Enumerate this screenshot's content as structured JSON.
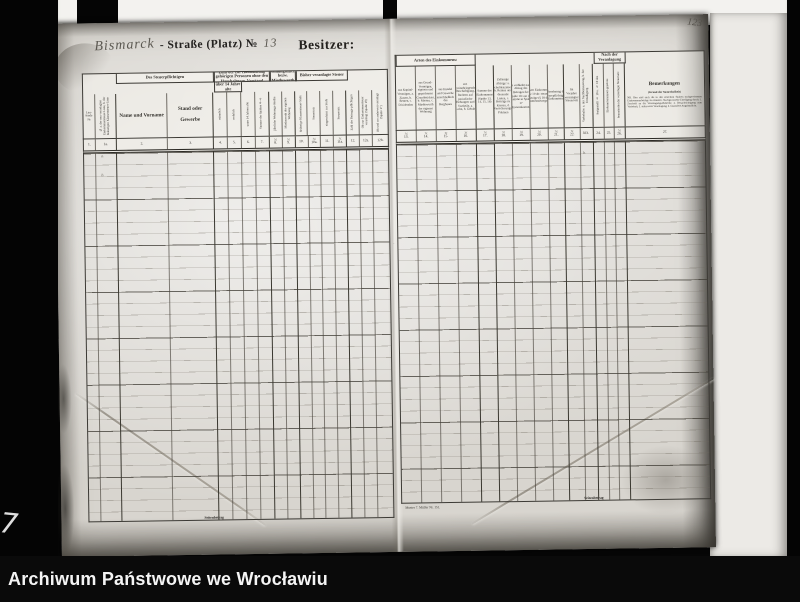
{
  "archive_bar": {
    "label": "Archiwum Państwowe we Wrocławiu"
  },
  "frame_marks": {
    "corner_mark": "7",
    "page_number": "123"
  },
  "document": {
    "street_name_handwritten": "Bismarck",
    "street_label_printed": "- Straße (Platz) №",
    "street_number_handwritten": "13",
    "owner_label": "Besitzer:",
    "marks": [
      {
        "x": 45,
        "y": 130,
        "t": "a."
      },
      {
        "x": 45,
        "y": 149,
        "t": "b."
      },
      {
        "x": 333,
        "y": 125,
        "t": "·"
      },
      {
        "x": 336,
        "y": 222,
        "t": "·"
      },
      {
        "x": 332,
        "y": 312,
        "t": "·"
      },
      {
        "x": 527,
        "y": 114,
        "t": "b."
      },
      {
        "x": 527,
        "y": 134,
        "t": "b."
      }
    ],
    "left_table": {
      "x": 27,
      "y": 50,
      "w": 306,
      "head_h": 64,
      "band_h": 20,
      "body_h": 368,
      "footer_label": "Seitenbetrag",
      "footer_x": 115,
      "groups": [
        {
          "label": "Des Steuerpflichtigen",
          "from": 2,
          "to": 3,
          "line": 1
        },
        {
          "label": "Zahl der zur Haushaltung gehörigen Personen ohne den Haushaltungs-Vorstand",
          "from": 4,
          "to": 7,
          "line": 1
        },
        {
          "label": "Wohnungsmiethe bezw. Miethswerth",
          "from": 8,
          "to": 9,
          "line": 1
        },
        {
          "label": "Bisher veranlagte Steuer",
          "from": 10,
          "to": 13,
          "line": 1
        },
        {
          "label": "über 14 Jahre alte",
          "from": 4,
          "to": 5,
          "line": 2
        }
      ],
      "columns": [
        {
          "num": "1.",
          "label": "Lau- fende №",
          "w": 12,
          "orient": "h"
        },
        {
          "num": "1a.",
          "label": "№ a. der neu veranlagten Einkommensteuer-Liste, b. der bisherigen Klassensteuer-Liste",
          "w": 21,
          "orient": "v",
          "bold_right": true
        },
        {
          "num": "2.",
          "label": "Name und Vorname",
          "w": 52,
          "orient": "h",
          "bold": true
        },
        {
          "num": "3.",
          "label": "Stand oder Gewerbe",
          "w": 46,
          "orient": "h",
          "bold": true,
          "bold_right": true
        },
        {
          "num": "4.",
          "label": "männlich",
          "w": 14,
          "orient": "v"
        },
        {
          "num": "5.",
          "label": "weiblich",
          "w": 14,
          "orient": "v"
        },
        {
          "num": "6.",
          "label": "unter 14 Jahren alte",
          "w": 14,
          "orient": "v"
        },
        {
          "num": "7.",
          "label": "Summe der Spalten 4—6",
          "w": 14,
          "orient": "v",
          "bold_right": true
        },
        {
          "num": "8.",
          "label": "jährliche Wohnungs-miethe",
          "w": 13,
          "orient": "v",
          "unit": "ℳ"
        },
        {
          "num": "9.",
          "label": "Miethswerth der eigenen Wohnung",
          "w": 13,
          "orient": "v",
          "unit": "ℳ",
          "bold_right": true
        },
        {
          "num": "10.",
          "label": "bisherige Klassensteuer-Stufe",
          "w": 13,
          "orient": "v"
        },
        {
          "num": "10a.",
          "label": "Steuersatz",
          "w": 13,
          "orient": "v",
          "unit": "ℳ"
        },
        {
          "num": "11.",
          "label": "eingeschätzt zur Stufe",
          "w": 13,
          "orient": "v"
        },
        {
          "num": "11a.",
          "label": "Steuersatz",
          "w": 13,
          "orient": "v",
          "unit": "ℳ",
          "bold_right": true
        },
        {
          "num": "12.",
          "label": "Zahl der Beitrags-pflichtigen",
          "w": 13,
          "orient": "v"
        },
        {
          "num": "12a.",
          "label": "Ob zur Einkommensteuer veranlagt (Spalte 19)",
          "w": 13,
          "orient": "v"
        },
        {
          "num": "12b.",
          "label": "Ob und wo anderweit veranlagt (Spalte 17)",
          "w": 15,
          "orient": "v"
        }
      ]
    },
    "right_table": {
      "x": 340,
      "y": 36,
      "w": 310,
      "head_h": 74,
      "band_h": 11,
      "body_h": 358,
      "footer_label": "Seitenbetrag",
      "footer_x": 182,
      "imprint": "Muster 7.  Müller Nr. 151.",
      "groups": [
        {
          "label": "Arten des Einkommens:",
          "from": 0,
          "to": 3,
          "line": 1
        },
        {
          "label": "Nach der Veranlagung",
          "from": 11,
          "to": 13,
          "line": 1
        }
      ],
      "columns": [
        {
          "num": "13.",
          "label": "aus Kapital-Vermögen, a. Zinsen, b. Renten, c. Dividenden",
          "w": 20,
          "orient": "h",
          "unit": "ℳ"
        },
        {
          "num": "14.",
          "label": "aus Grund-Vermögen, eigenen und gepachteten Grundstücken, b. Mieten, c. Miethswerth der eigenen Wohnung",
          "w": 20,
          "orient": "h",
          "unit": "ℳ"
        },
        {
          "num": "15.",
          "label": "aus Handel und Gewerbe einschließlich des Bergbaues",
          "w": 20,
          "orient": "h",
          "unit": "ℳ"
        },
        {
          "num": "16.",
          "label": "aus gewinnbringender Beschäftigung, Rechten auf periodische Hebungen und Vortheile, a. Lohn, b. Gehalt",
          "w": 20,
          "orient": "h",
          "unit": "ℳ",
          "bold_right": true
        },
        {
          "num": "17.",
          "label": "Summe des Einkommens (Spalte 13, 14, 15, 16)",
          "w": 19,
          "orient": "h",
          "unit": "ℳ",
          "bold_right": true
        },
        {
          "num": "18.",
          "label": "Zulässige Abzüge: a. Schuldenzinsen, b. Renten und dauernde Lasten, c. Beiträge zu Kassen, d. Versicherungs-Prämien",
          "w": 18,
          "orient": "h",
          "unit": "ℳ"
        },
        {
          "num": "19.",
          "label": "Es verbleibt nach Abzug des Betrages der Spalte 18 von der Summe in Spalte 17 Jahreseinkommen",
          "w": 18,
          "orient": "h",
          "unit": "ℳ"
        },
        {
          "num": "20.",
          "label": "Von dem Einkommen der Spalte 19 ab: steuerfreie Beträge (§ 18 des Einkommensteuergesetzes)",
          "w": 18,
          "orient": "h",
          "unit": "ℳ"
        },
        {
          "num": "21.",
          "label": "Jahresbetrag des steuerpflichtigen Einkommens",
          "w": 16,
          "orient": "h",
          "unit": "ℳ",
          "bold_right": true
        },
        {
          "num": "22.",
          "label": "Im Vorjahre veranlagter Steuersatz",
          "w": 16,
          "orient": "h",
          "unit": "ℳ"
        },
        {
          "num": "23.",
          "label": "Vorbehalte: a. der Nachbesteuerung, b. der Ermäßigung",
          "w": 13,
          "orient": "v",
          "bold_right": true
        },
        {
          "num": "24.",
          "label": "festgestellt § 18 u. § 19 des",
          "w": 11,
          "orient": "v"
        },
        {
          "num": "25.",
          "label": "Einkommensteuer-gesetzes",
          "w": 10,
          "orient": "v"
        },
        {
          "num": "26.",
          "label": "beanstandet der veranlagte Steuersatz",
          "w": 11,
          "orient": "v",
          "unit": "ℳ",
          "bold_right": true
        },
        {
          "num": "27.",
          "label": "Bemerkungen",
          "w": 80,
          "orient": "h",
          "bold": true,
          "sub": "(Grund der Steuerfreiheit)",
          "note": "NB. Hier sind auch die in den einzelnen Spalten nachgewiesenen Einkommensbeträge zu erläutern. Nachgewiesene Erledigung durch: 1. Zuschrift an die Veranlagungs-Behörde; 2. Benachrichtigung zum Vorbehalt; 3. anderweite Veranlagung; 4. besondere Angabepflicht."
        }
      ]
    }
  }
}
